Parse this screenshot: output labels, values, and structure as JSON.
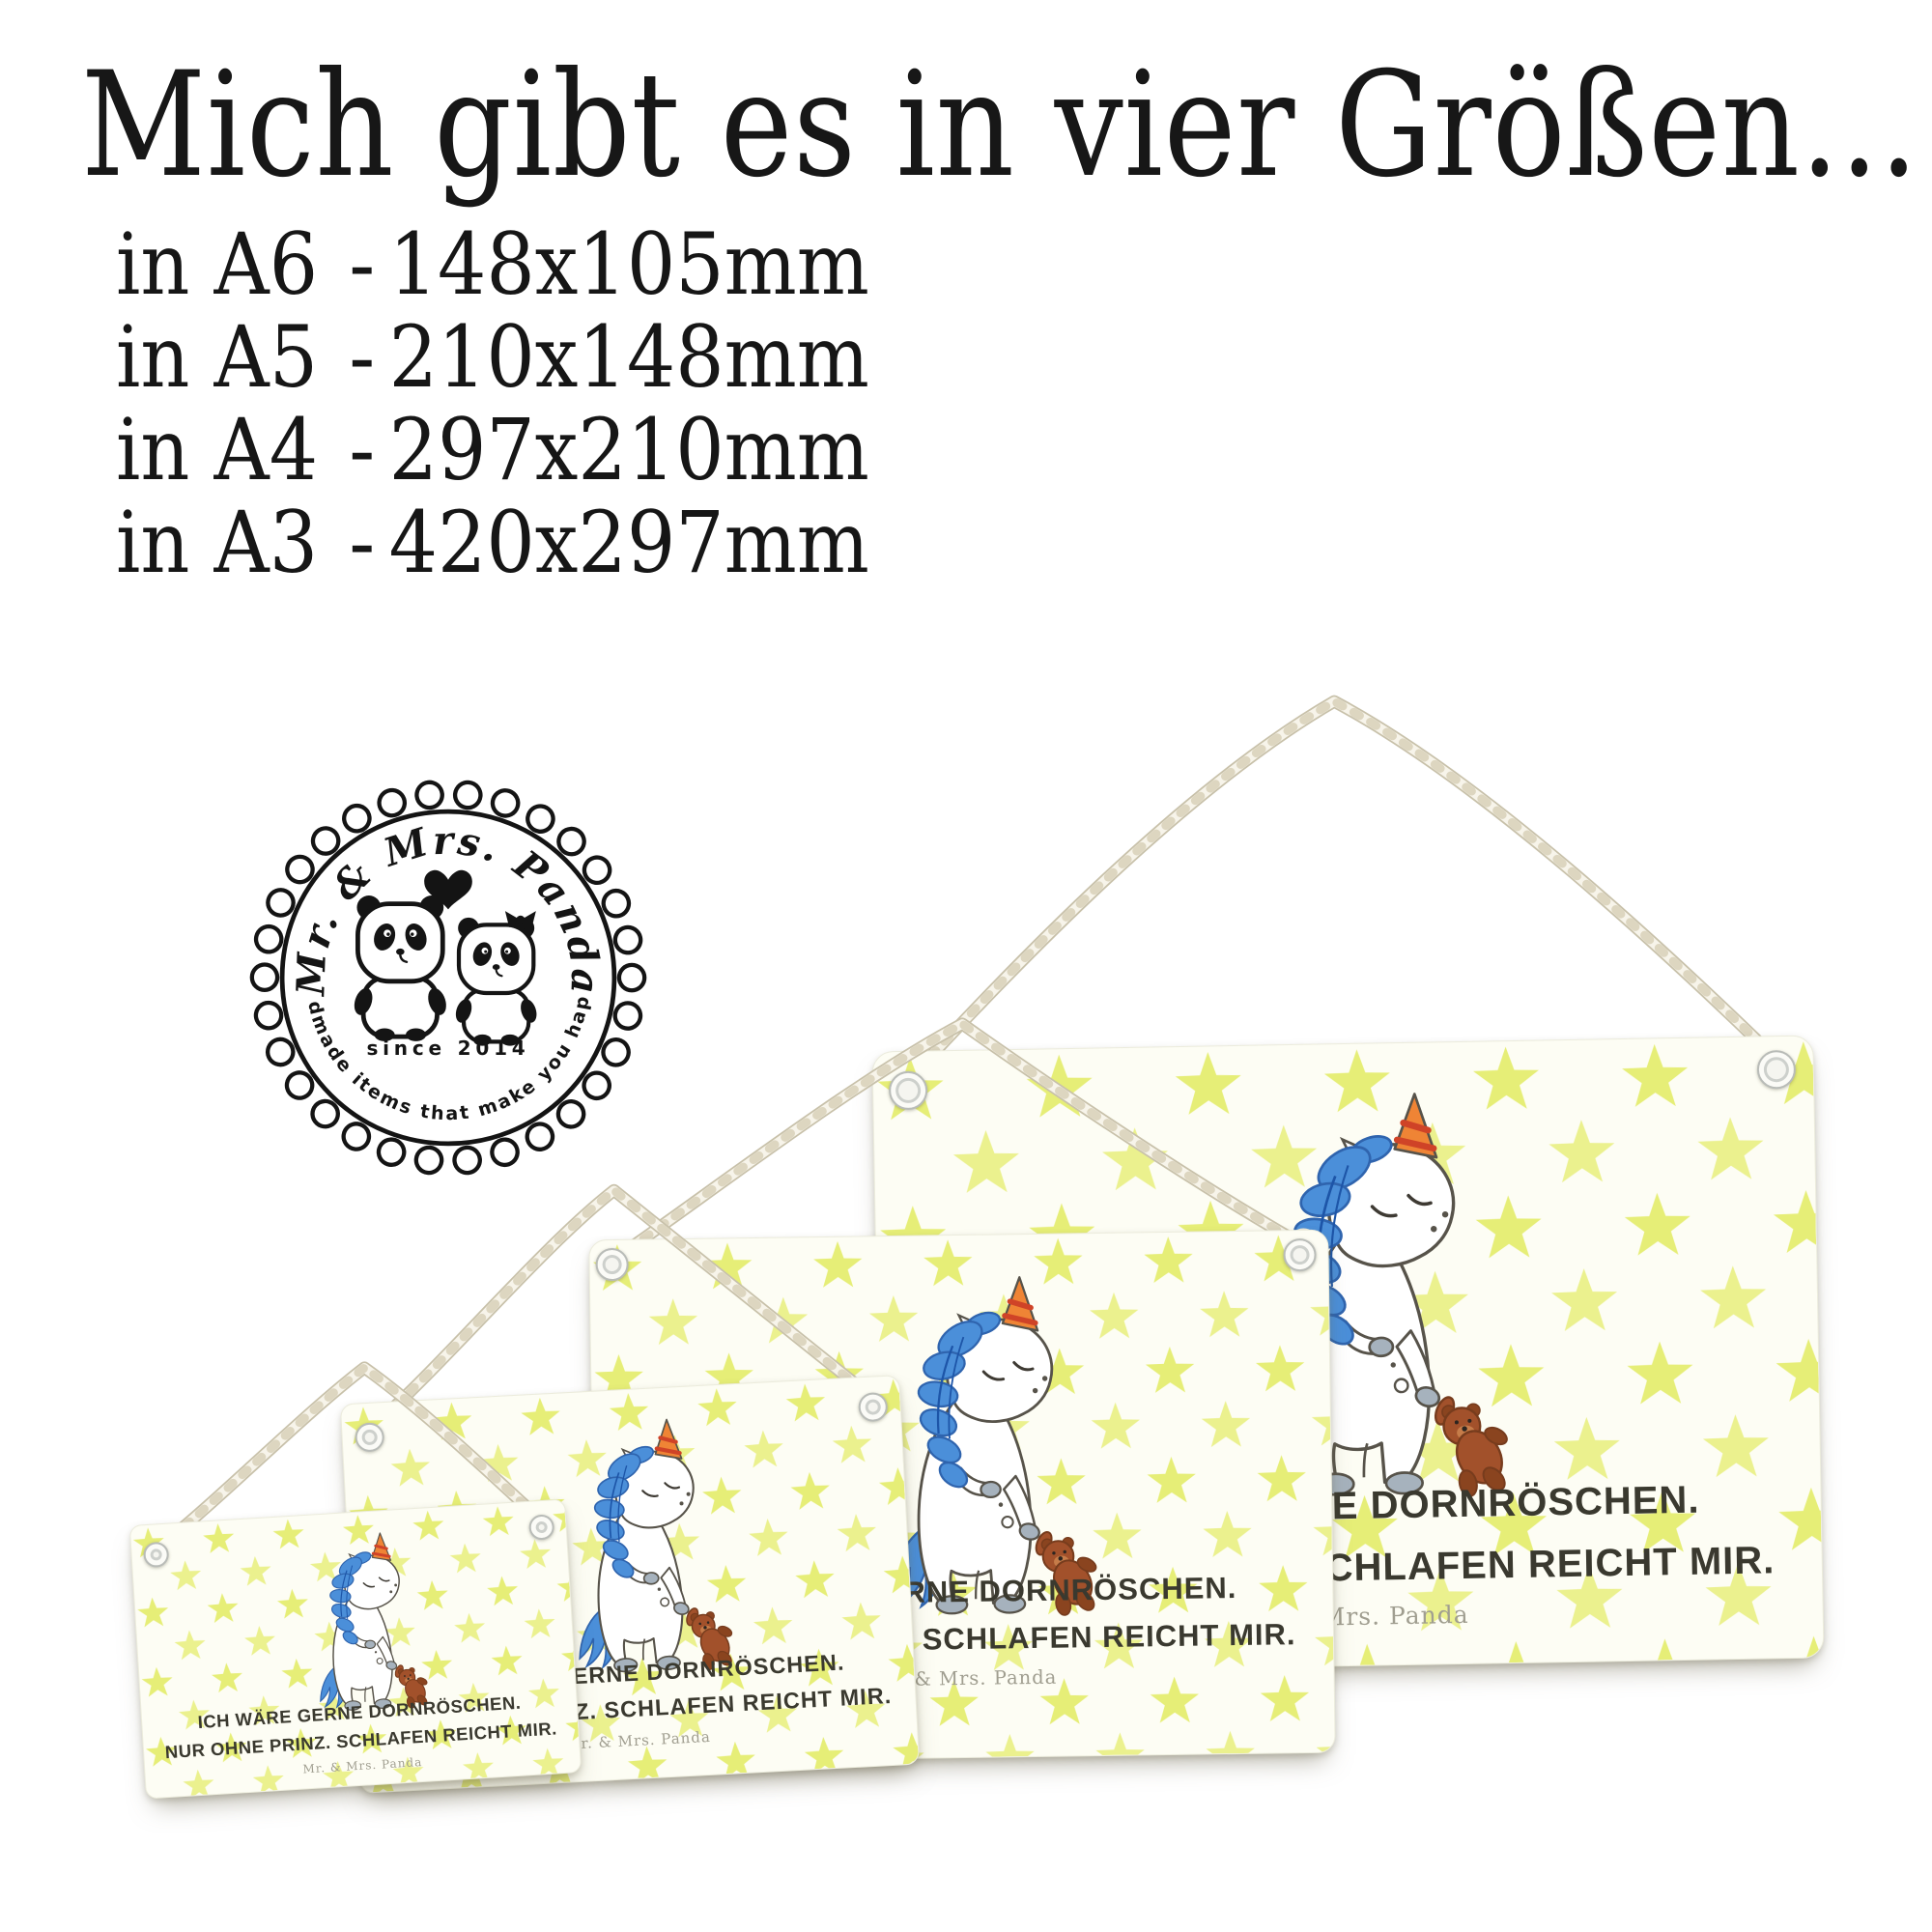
{
  "headline": "Mich gibt es in vier Größen...",
  "size_separator": "-",
  "sizes": [
    {
      "label": "in A6",
      "dimensions": "148x105mm"
    },
    {
      "label": "in A5",
      "dimensions": "210x148mm"
    },
    {
      "label": "in A4",
      "dimensions": "297x210mm"
    },
    {
      "label": "in A3",
      "dimensions": "420x297mm"
    }
  ],
  "badge": {
    "brand": "Mr. & Mrs. Panda",
    "since": "since 2014",
    "tagline": "Handmade items that make you happy!"
  },
  "sign": {
    "line1": "ICH WÄRE GERNE DORNRÖSCHEN.",
    "line2": "NUR OHNE PRINZ. SCHLAFEN REICHT MIR.",
    "brand": "Mr. & Mrs. Panda"
  },
  "colors": {
    "star_yellow_green": "#e6ee77",
    "board_white": "#fdfdf4",
    "mane_blue": "#4b8fd9",
    "mane_blue_dark": "#2f64ae",
    "horn_orange": "#ef8435",
    "horn_stripe_red": "#cf4327",
    "hoof_gray": "#a6b2bd",
    "teddy_brown": "#a2512b",
    "caption_dark": "#3a392f",
    "brand_gray": "#a09e90",
    "rope_cream": "#f7f4ea",
    "badge_black": "#141414"
  }
}
